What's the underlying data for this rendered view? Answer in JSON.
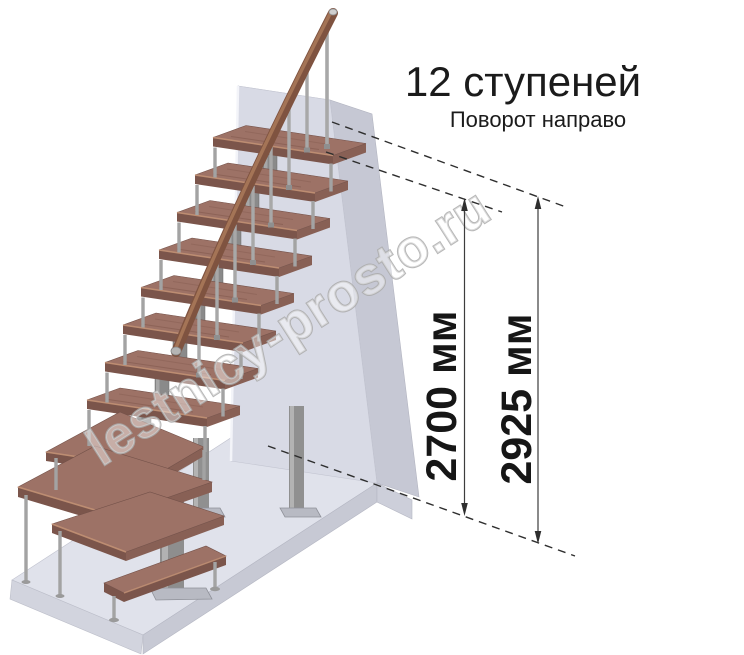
{
  "header": {
    "title": "12 ступеней",
    "subtitle": "Поворот направо"
  },
  "dimensions": [
    {
      "id": "floor-to-top-step",
      "label": "2700 мм"
    },
    {
      "id": "floor-to-floor",
      "label": "2925 мм"
    }
  ],
  "watermark": {
    "text": "lestnicy-prosto.ru"
  },
  "stairs": {
    "step_count": "12",
    "turn_direction": "направо"
  },
  "colors": {
    "tread_top": "#9d7266",
    "tread_front": "#7b554b",
    "tread_side": "#886055",
    "tread_edge_highlight": "#c49376",
    "handrail": "#7f5340",
    "metal": "#a3a3a3",
    "wall_front": "#d8dae5",
    "wall_side": "#c6c8d4",
    "floor_top": "#e0e2eb",
    "dimension_line": "#3d3d3d",
    "text": "#1b1b1b"
  }
}
